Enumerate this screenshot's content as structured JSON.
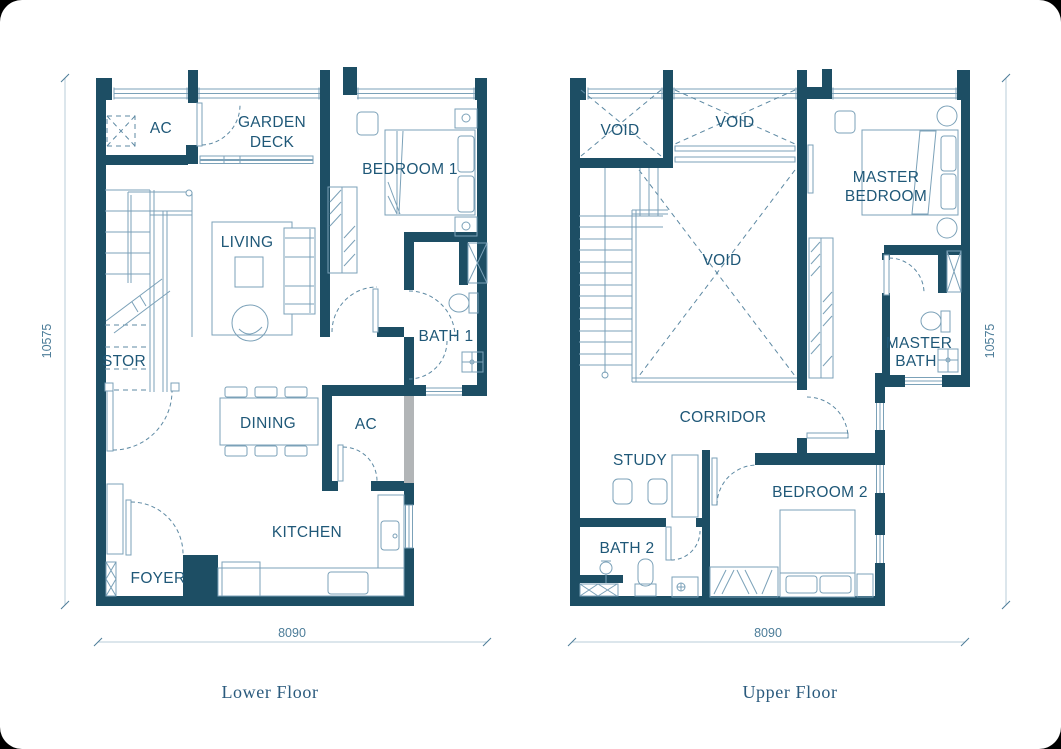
{
  "floors": {
    "lower": {
      "caption": "Lower Floor",
      "dim_bottom": "8090",
      "dim_left": "10575",
      "rooms": {
        "ac_top": "AC",
        "garden_line1": "GARDEN",
        "garden_line2": "DECK",
        "bedroom1": "BEDROOM 1",
        "living": "LIVING",
        "stor": "STOR",
        "bath1": "BATH 1",
        "dining": "DINING",
        "ac_mid": "AC",
        "kitchen": "KITCHEN",
        "foyer": "FOYER"
      }
    },
    "upper": {
      "caption": "Upper Floor",
      "dim_bottom": "8090",
      "dim_right": "10575",
      "rooms": {
        "void_left": "VOID",
        "void_top": "VOID",
        "void_center": "VOID",
        "master_bedroom_line1": "MASTER",
        "master_bedroom_line2": "BEDROOM",
        "master_bath_line1": "MASTER",
        "master_bath_line2": "BATH",
        "corridor": "CORRIDOR",
        "study": "STUDY",
        "bedroom2": "BEDROOM 2",
        "bath2": "BATH 2"
      }
    }
  },
  "colors": {
    "wall": "#1d4e64",
    "furniture": "#7ba1b8",
    "label": "#1f5878",
    "dashed": "#5d89a3",
    "dim_text": "#4d7d99",
    "dim_line": "#b9cdd9",
    "gray_wall": "#b2b5b7",
    "caption": "#2a5a7d"
  }
}
